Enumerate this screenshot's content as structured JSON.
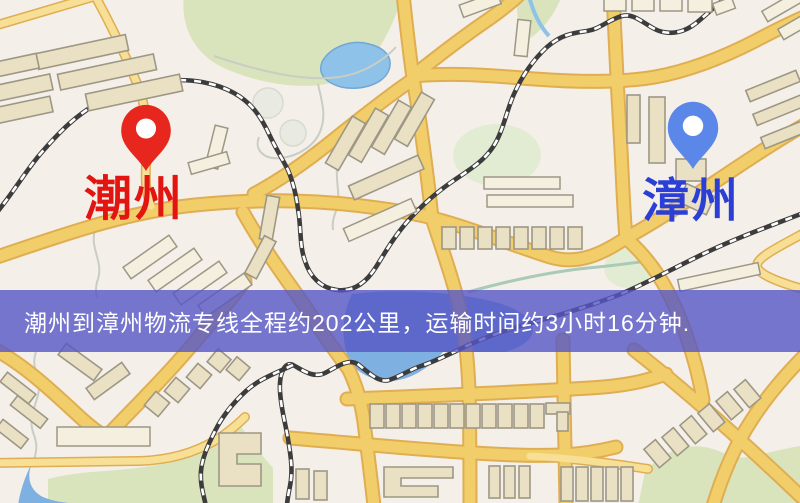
{
  "banner": {
    "text": "潮州到漳州物流专线全程约202公里，运输时间约3小时16分钟.",
    "bg_color_hex": "#5656C6",
    "bg_opacity": 0.8,
    "text_color": "#FFFFFF"
  },
  "markers": [
    {
      "id": "origin",
      "label": "潮州",
      "label_color": "#E21510",
      "pin_color": "#E7261D",
      "pin_style": "red-map-pin"
    },
    {
      "id": "destination",
      "label": "漳州",
      "label_color": "#2B3FD6",
      "pin_color": "#5B88E8",
      "pin_style": "blue-map-pin"
    }
  ],
  "colors": {
    "bg": "#f5efe9",
    "road": "#f2ce6a",
    "road-case": "#dfae52",
    "road-minor": "#f7df95",
    "bld": "#eae1c5",
    "bld-stroke": "#9d9785",
    "park": "#d9e4bd",
    "water": "#7fb0e2",
    "rail": "#3c3c3c",
    "banner": "rgba(86,86,198,0.80)",
    "label-red": "#e21510",
    "label-blue": "#2b3fd6",
    "pin-red": "#e7261d",
    "pin-blue": "#5b88e8"
  }
}
